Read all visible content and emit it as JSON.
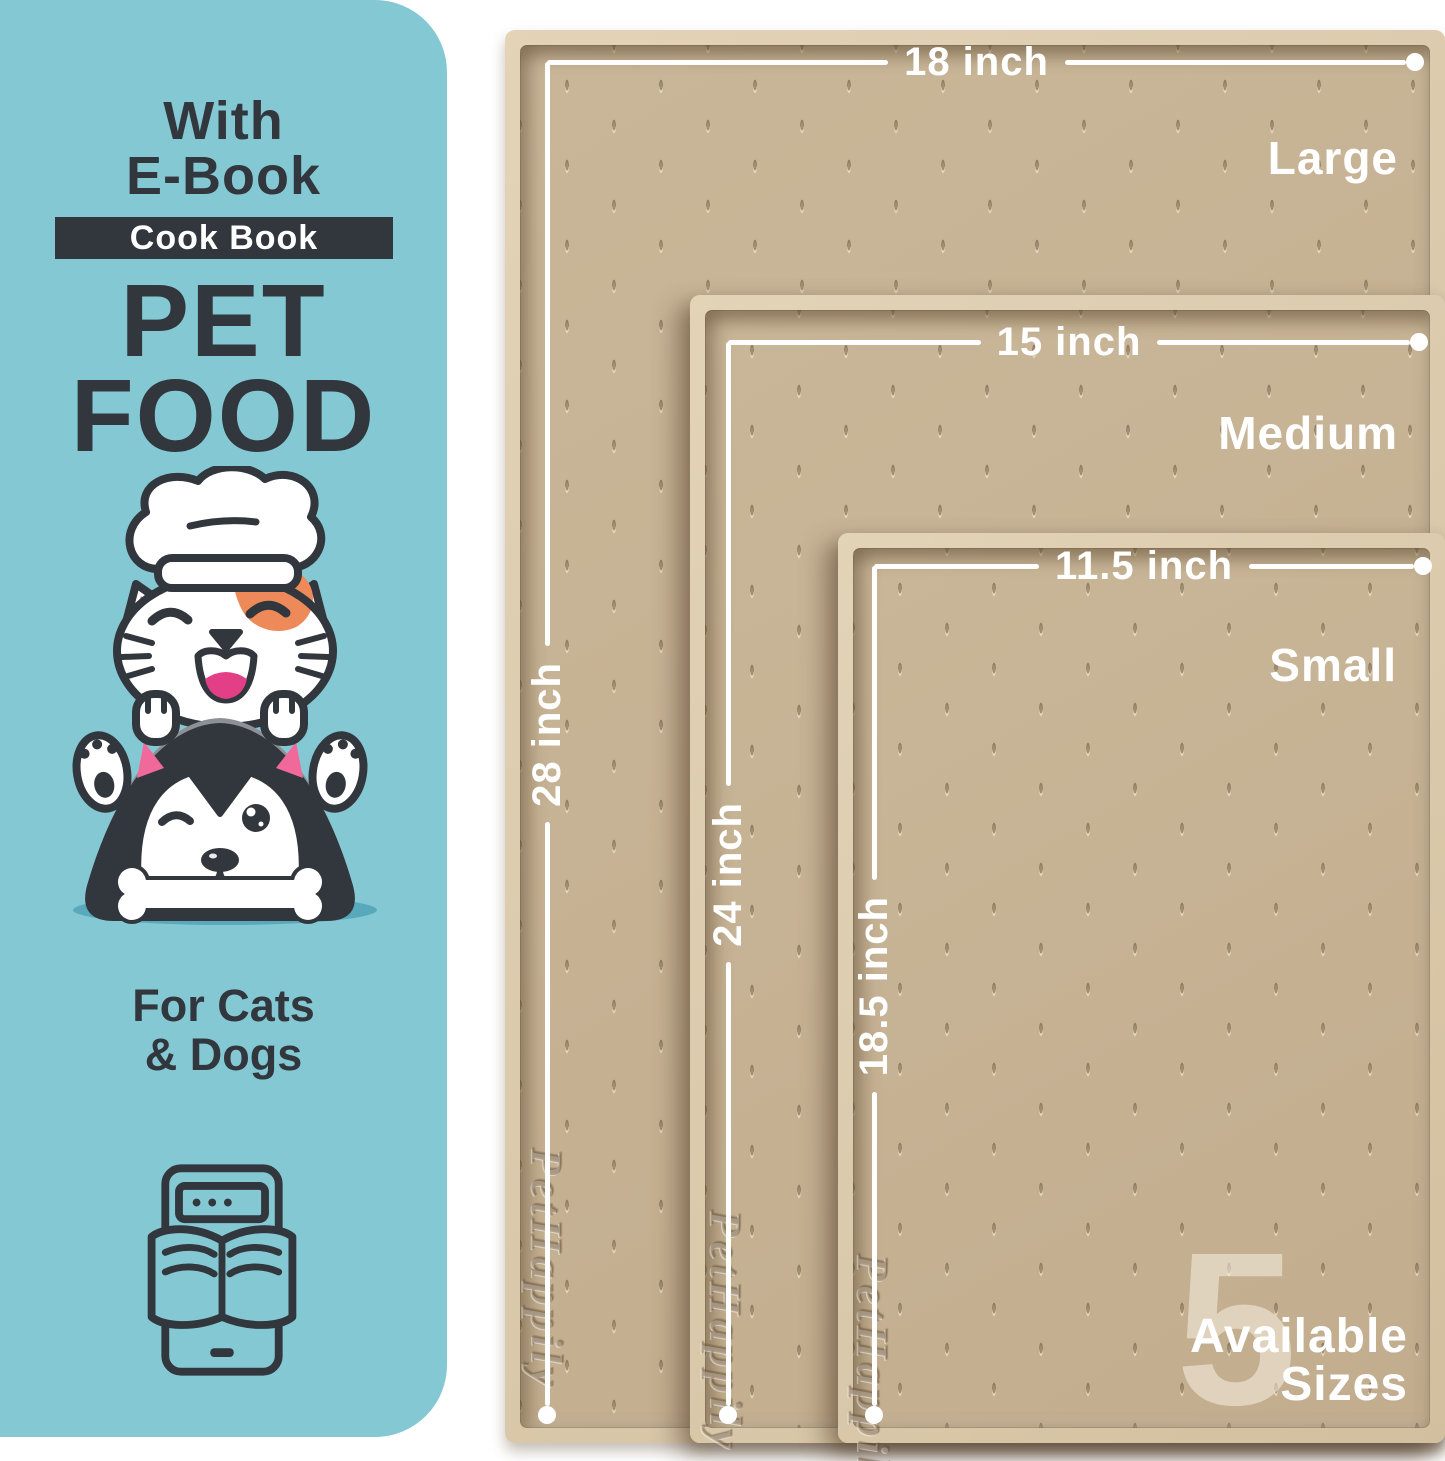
{
  "colors": {
    "teal": "#84c8d4",
    "teal-shadow": "#58a9bc",
    "ink": "#32363d",
    "mat-rim": "#dbc9ac",
    "mat-surface": "#c9b698",
    "mat-surface-dark": "#c2ad8e",
    "white": "#ffffff",
    "pink": "#f0699a",
    "deep-pink": "#e23f86",
    "orange": "#ee8a5a",
    "emboss": "#8a7354"
  },
  "left_panel": {
    "heading_line1": "With",
    "heading_line2": "E-Book",
    "badge": "Cook Book",
    "title_line1": "PET",
    "title_line2": "FOOD",
    "audience_line1": "For Cats",
    "audience_line2": "& Dogs"
  },
  "mats": [
    {
      "name": "Large",
      "width_label": "18 inch",
      "height_label": "28 inch",
      "brand": "PetHappily"
    },
    {
      "name": "Medium",
      "width_label": "15 inch",
      "height_label": "24 inch",
      "brand": "PetHappily"
    },
    {
      "name": "Small",
      "width_label": "11.5 inch",
      "height_label": "18.5 inch",
      "brand": "PetHappily"
    }
  ],
  "sizes_callout": {
    "count": "5",
    "line1": "Available",
    "line2": "Sizes"
  }
}
